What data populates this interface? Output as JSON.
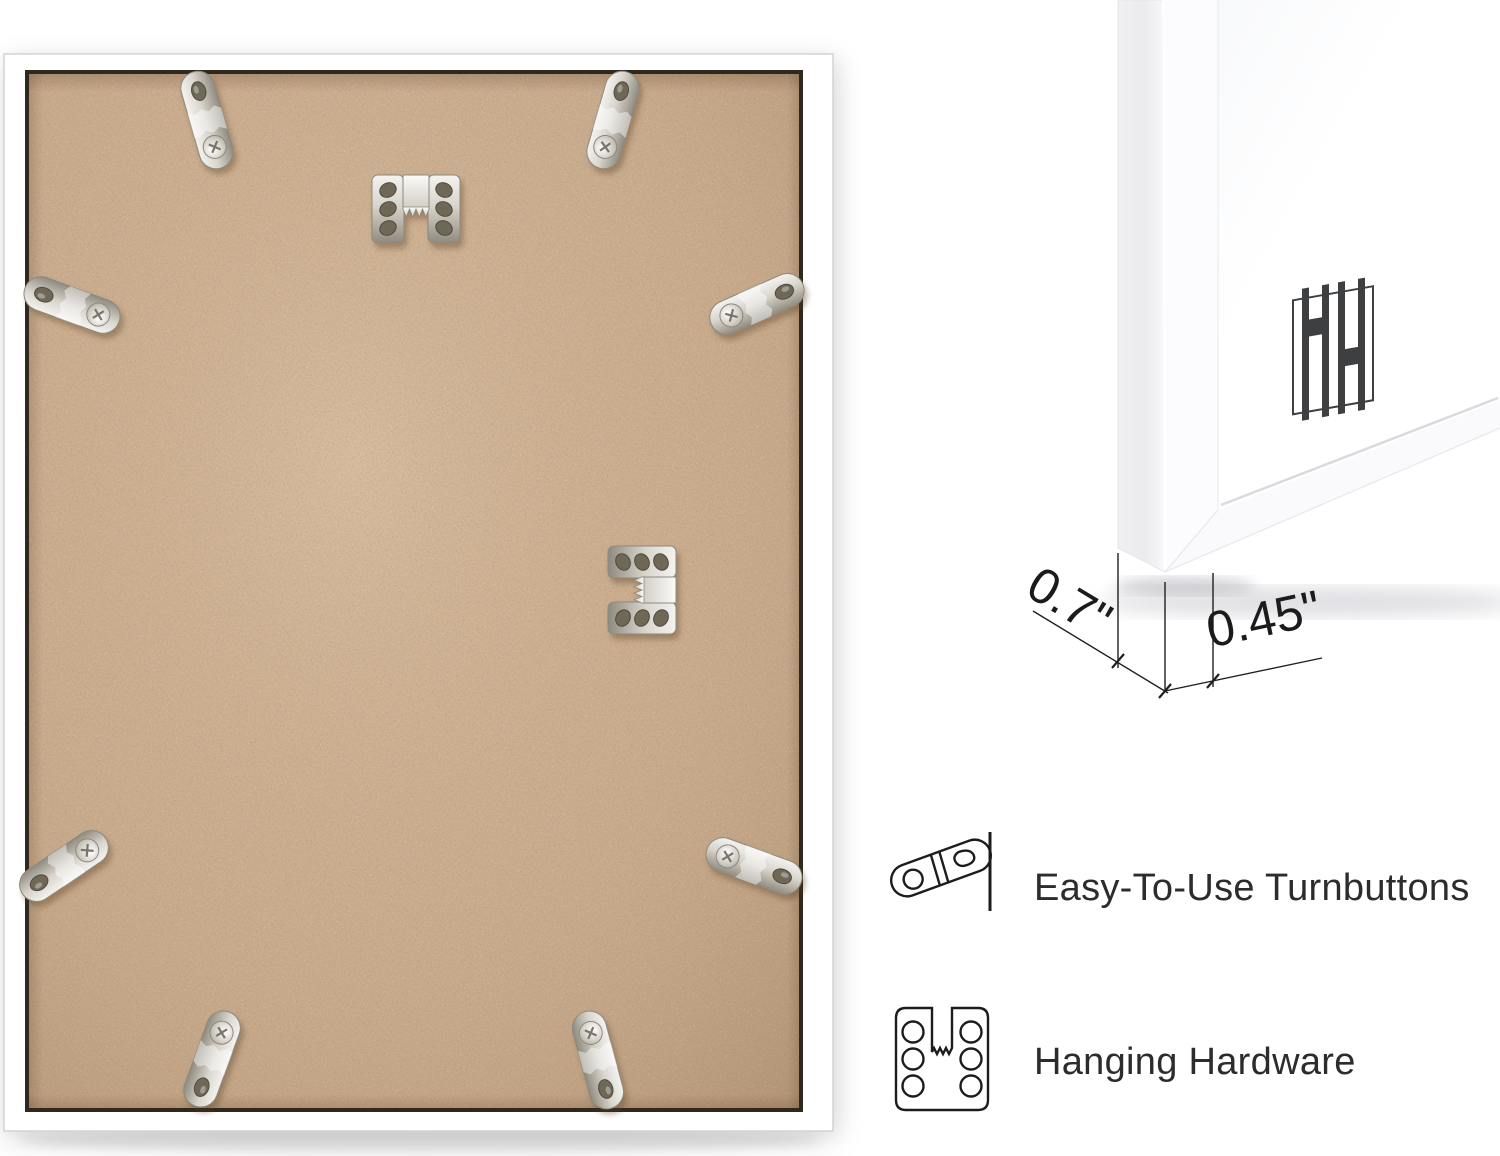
{
  "image": {
    "kind": "product-photo-collage",
    "background": "#ffffff"
  },
  "product_photo": {
    "subject": "picture-frame-back",
    "frame_color": "#ffffff",
    "backing_color": "#c9ab8d",
    "hardware": {
      "turnbutton_count": 8,
      "sawtooth_hanger_count": 2
    }
  },
  "corner_closeup": {
    "subject": "frame-corner-front",
    "frame_color": "#ffffff",
    "monogram": "HH",
    "monogram_color": "#3e3f41"
  },
  "dimensions": {
    "depth": "0.7\"",
    "face_width": "0.45\""
  },
  "features": [
    {
      "icon": "turnbutton-icon",
      "label": "Easy-To-Use Turnbuttons"
    },
    {
      "icon": "sawtooth-hanger-icon",
      "label": "Hanging Hardware"
    }
  ],
  "colors": {
    "annotation": "#1f1f1f",
    "metal_light": "#f4f3f0",
    "metal_dark": "#8f8a7f",
    "mdf_edge": "#2e281e"
  }
}
